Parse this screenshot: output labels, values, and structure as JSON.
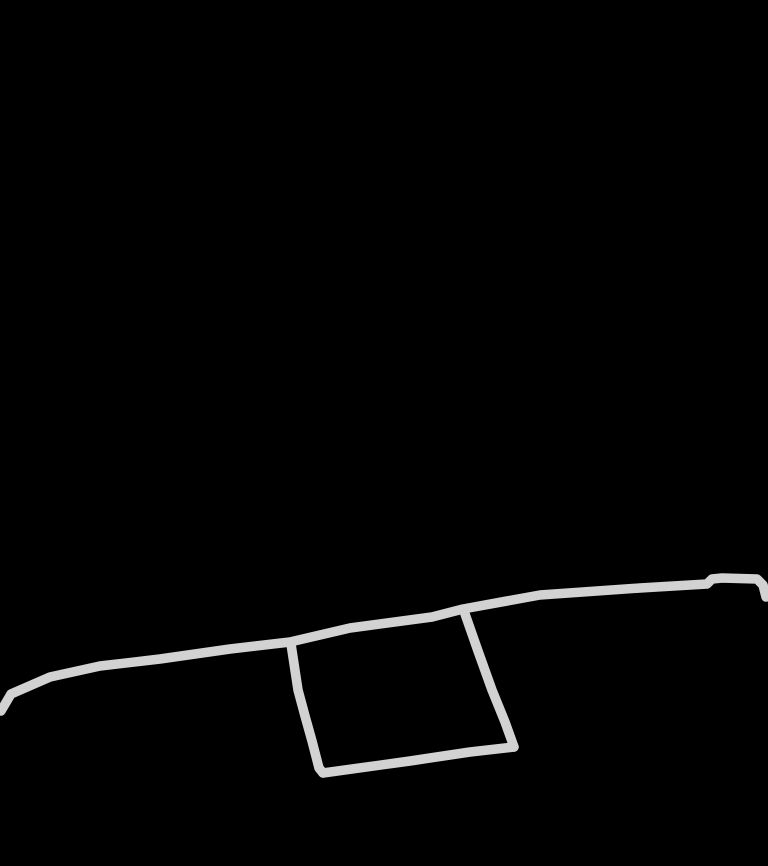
{
  "canvas": {
    "width": 768,
    "height": 866,
    "background_color": "#000000",
    "stroke_color": "#d2d2d2",
    "stroke_width": 9.5,
    "strokes": [
      {
        "name": "freehand-long-line",
        "points": [
          [
            1,
            711
          ],
          [
            11,
            694
          ],
          [
            50,
            677
          ],
          [
            100,
            666
          ],
          [
            160,
            659
          ],
          [
            230,
            649
          ],
          [
            290,
            642
          ],
          [
            350,
            628
          ],
          [
            432,
            617
          ],
          [
            463,
            609
          ],
          [
            540,
            595
          ],
          [
            640,
            588
          ],
          [
            707,
            584
          ],
          [
            712,
            579
          ],
          [
            722,
            578
          ],
          [
            757,
            579
          ],
          [
            763,
            585
          ],
          [
            766,
            597
          ]
        ]
      },
      {
        "name": "freehand-quad-left-edge",
        "points": [
          [
            291,
            644
          ],
          [
            298,
            690
          ],
          [
            305,
            716
          ],
          [
            312,
            741
          ],
          [
            319,
            768
          ],
          [
            323,
            773
          ]
        ]
      },
      {
        "name": "freehand-quad-bottom-edge",
        "points": [
          [
            323,
            773
          ],
          [
            410,
            761
          ],
          [
            470,
            752
          ],
          [
            514,
            747
          ]
        ]
      },
      {
        "name": "freehand-quad-right-edge",
        "points": [
          [
            464,
            611
          ],
          [
            478,
            651
          ],
          [
            492,
            690
          ],
          [
            505,
            722
          ],
          [
            514,
            747
          ]
        ]
      }
    ]
  }
}
